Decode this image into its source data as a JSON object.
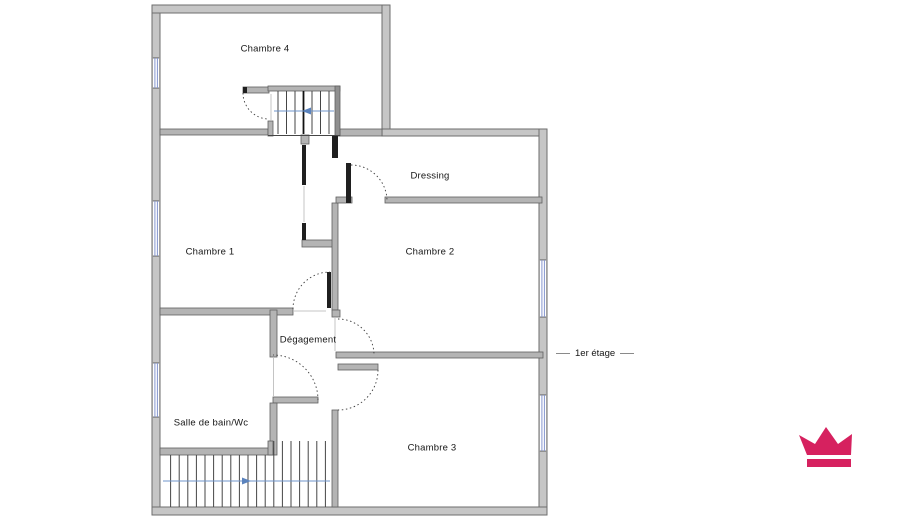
{
  "floor_plan": {
    "title_label": "1er étage",
    "rooms": [
      {
        "label": "Chambre 4"
      },
      {
        "label": "Chambre 1"
      },
      {
        "label": "Dressing"
      },
      {
        "label": "Chambre 2"
      },
      {
        "label": "Dégagement"
      },
      {
        "label": "Salle de bain/Wc"
      },
      {
        "label": "Chambre 3"
      }
    ],
    "stairs": [
      {
        "name": "upper-staircase",
        "arrow_direction": "left"
      },
      {
        "name": "lower-staircase",
        "arrow_direction": "right"
      }
    ],
    "windows_count": 5,
    "doors_count": 6,
    "colors": {
      "wall_gray": "#c6c6c6",
      "interior_wall_gray": "#b4b4b4",
      "stair_arrow_blue": "#5b83bd",
      "window_blue": "#8495cf",
      "logo_pink": "#d6215f"
    },
    "logo": {
      "icon": "crown-icon"
    }
  }
}
